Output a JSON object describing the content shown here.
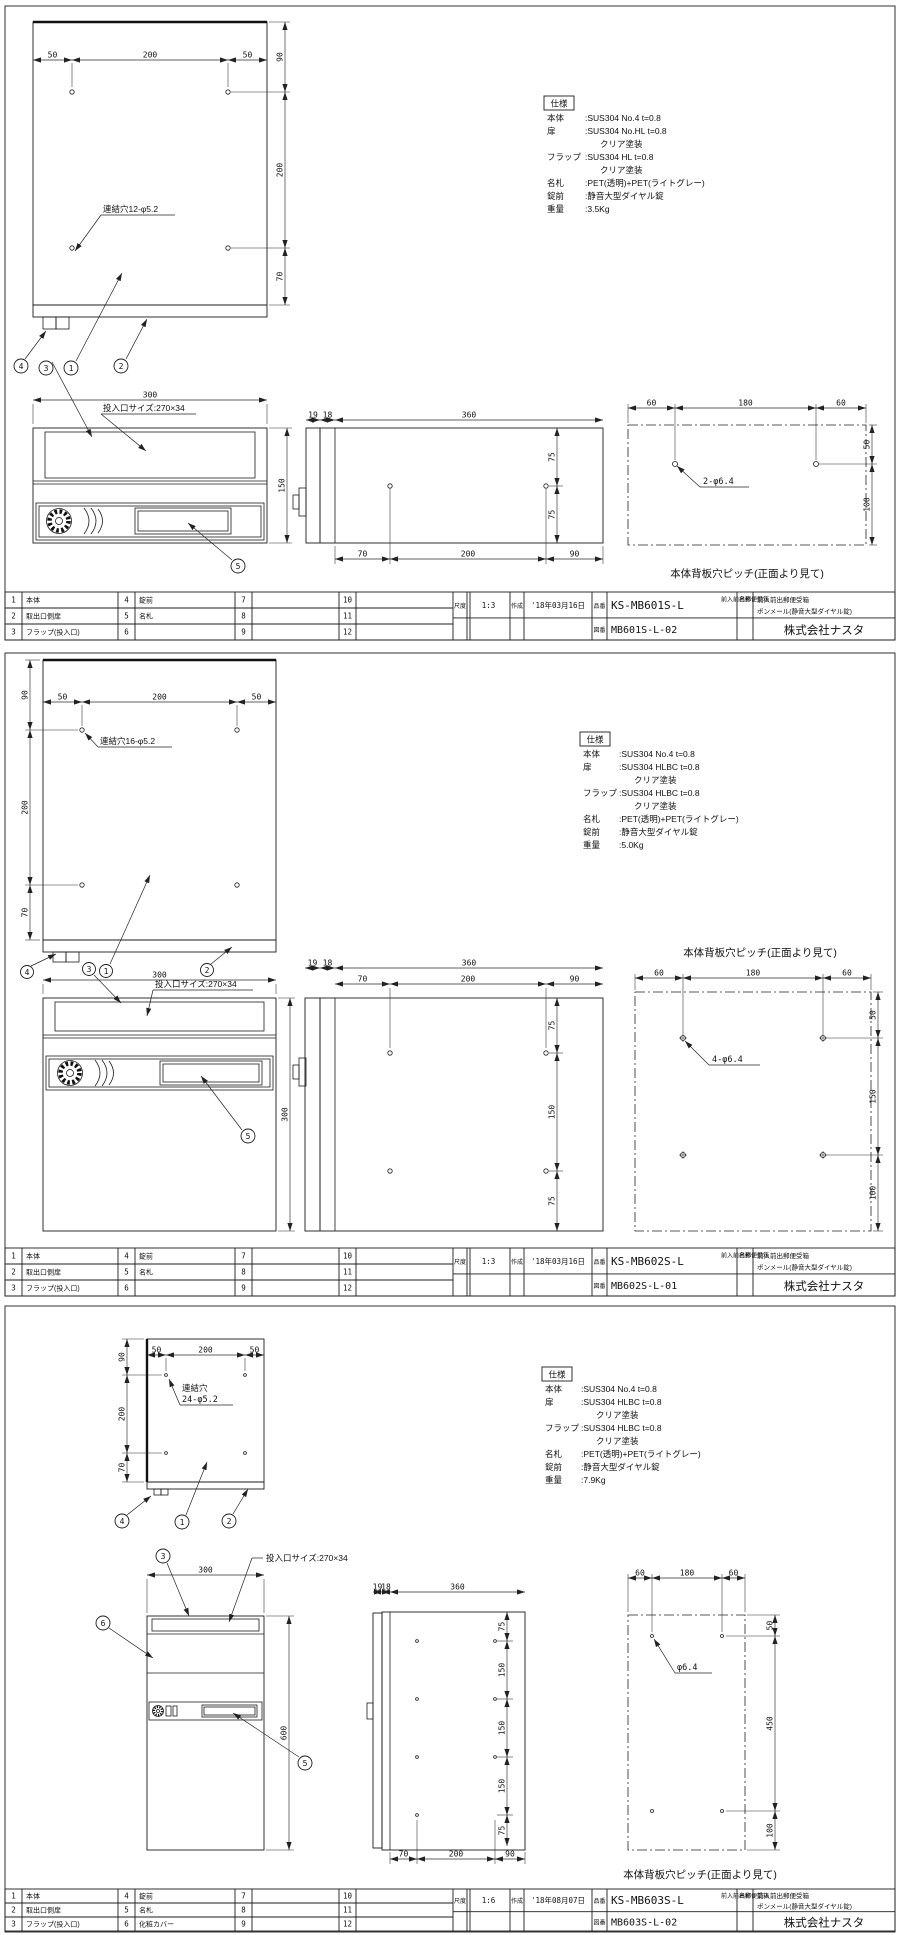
{
  "company": "株式会社ナスタ",
  "tb_labels": {
    "scale": "尺度",
    "made": "作成",
    "code": "品番",
    "dwg": "図番",
    "name": "名称"
  },
  "sheets": [
    {
      "title": {
        "scale": "1:3",
        "date": "'18年03月16日",
        "code": "KS-MB601S-L",
        "dwg": "MB601S-L-02",
        "name1": "前入前出郵便受箱",
        "name2": "ポンメール(静音大型ダイヤル錠)"
      },
      "spec": {
        "title": "仕様",
        "rows": [
          {
            "label": "本体",
            "value": ":SUS304 No.4 t=0.8"
          },
          {
            "label": "扉",
            "value": ":SUS304 No.HL t=0.8"
          },
          {
            "label": "",
            "value": "クリア塗装"
          },
          {
            "label": "フラップ",
            "value": ":SUS304 HL t=0.8"
          },
          {
            "label": "",
            "value": "クリア塗装"
          },
          {
            "label": "名札",
            "value": ":PET(透明)+PET(ライトグレー)"
          },
          {
            "label": "錠前",
            "value": ":静音大型ダイヤル錠"
          },
          {
            "label": "重量",
            "value": ":3.5Kg"
          }
        ]
      },
      "hole_label": "連結穴12-φ5.2",
      "slot_label": "投入口サイズ:270×34",
      "back_hole_label": "2-φ6.4",
      "back_caption": "本体背板穴ピッチ(正面より見て)",
      "callouts": {
        "c1": "1",
        "c2": "2",
        "c3": "3",
        "c4": "4",
        "c5": "5"
      },
      "dims": {
        "tv_top": [
          "50",
          "200",
          "50"
        ],
        "tv_side": [
          "90",
          "200",
          "70"
        ],
        "fv_w": "300",
        "fv_h": "150",
        "sv_front": [
          "19",
          "18"
        ],
        "sv_depth": "360",
        "sv_bottom": [
          "70",
          "200",
          "90"
        ],
        "sv_right": [
          "75",
          "75"
        ],
        "bv_top": [
          "60",
          "180",
          "60"
        ],
        "bv_right": [
          "50",
          "100"
        ]
      },
      "parts": [
        {
          "no": "1",
          "name": "本体"
        },
        {
          "no": "2",
          "name": "取出口側扉"
        },
        {
          "no": "3",
          "name": "フラップ(投入口)"
        },
        {
          "no": "4",
          "name": "錠前"
        },
        {
          "no": "5",
          "name": "名札"
        },
        {
          "no": "6",
          "name": ""
        },
        {
          "no": "7",
          "name": ""
        },
        {
          "no": "8",
          "name": ""
        },
        {
          "no": "9",
          "name": ""
        },
        {
          "no": "10",
          "name": ""
        },
        {
          "no": "11",
          "name": ""
        },
        {
          "no": "12",
          "name": ""
        }
      ]
    },
    {
      "title": {
        "scale": "1:3",
        "date": "'18年03月16日",
        "code": "KS-MB602S-L",
        "dwg": "MB602S-L-01",
        "name1": "前入前出郵便受箱",
        "name2": "ポンメール(静音大型ダイヤル錠)"
      },
      "spec": {
        "title": "仕様",
        "rows": [
          {
            "label": "本体",
            "value": ":SUS304 No.4 t=0.8"
          },
          {
            "label": "扉",
            "value": ":SUS304 HLBC t=0.8"
          },
          {
            "label": "",
            "value": "クリア塗装"
          },
          {
            "label": "フラップ",
            "value": ":SUS304 HLBC t=0.8"
          },
          {
            "label": "",
            "value": "クリア塗装"
          },
          {
            "label": "名札",
            "value": ":PET(透明)+PET(ライトグレー)"
          },
          {
            "label": "錠前",
            "value": ":静音大型ダイヤル錠"
          },
          {
            "label": "重量",
            "value": ":5.0Kg"
          }
        ]
      },
      "hole_label": "連結穴16-φ5.2",
      "slot_label": "投入口サイズ:270×34",
      "back_hole_label": "4-φ6.4",
      "back_caption": "本体背板穴ピッチ(正面より見て)",
      "callouts": {
        "c1": "1",
        "c2": "2",
        "c3": "3",
        "c4": "4",
        "c5": "5"
      },
      "dims": {
        "tv_top": [
          "50",
          "200",
          "50"
        ],
        "tv_side": [
          "90",
          "200",
          "70"
        ],
        "fv_w": "300",
        "fv_h": "300",
        "sv_front": [
          "19",
          "18"
        ],
        "sv_depth": "360",
        "sv_bottom": [
          "70",
          "200",
          "90"
        ],
        "sv_right": [
          "75",
          "150",
          "75"
        ],
        "bv_top": [
          "60",
          "180",
          "60"
        ],
        "bv_right": [
          "50",
          "150",
          "100"
        ]
      },
      "parts": [
        {
          "no": "1",
          "name": "本体"
        },
        {
          "no": "2",
          "name": "取出口側扉"
        },
        {
          "no": "3",
          "name": "フラップ(投入口)"
        },
        {
          "no": "4",
          "name": "錠前"
        },
        {
          "no": "5",
          "name": "名札"
        },
        {
          "no": "6",
          "name": ""
        },
        {
          "no": "7",
          "name": ""
        },
        {
          "no": "8",
          "name": ""
        },
        {
          "no": "9",
          "name": ""
        },
        {
          "no": "10",
          "name": ""
        },
        {
          "no": "11",
          "name": ""
        },
        {
          "no": "12",
          "name": ""
        }
      ]
    },
    {
      "title": {
        "scale": "1:6",
        "date": "'18年08月07日",
        "code": "KS-MB603S-L",
        "dwg": "MB603S-L-02",
        "name1": "前入前出郵便受箱",
        "name2": "ポンメール(静音大型ダイヤル錠)"
      },
      "spec": {
        "title": "仕様",
        "rows": [
          {
            "label": "本体",
            "value": ":SUS304 No.4 t=0.8"
          },
          {
            "label": "扉",
            "value": ":SUS304 HLBC t=0.8"
          },
          {
            "label": "",
            "value": "クリア塗装"
          },
          {
            "label": "フラップ",
            "value": ":SUS304 HLBC t=0.8"
          },
          {
            "label": "",
            "value": "クリア塗装"
          },
          {
            "label": "名札",
            "value": ":PET(透明)+PET(ライトグレー)"
          },
          {
            "label": "錠前",
            "value": ":静音大型ダイヤル錠"
          },
          {
            "label": "重量",
            "value": ":7.9Kg"
          }
        ]
      },
      "hole_label_1": "連結穴",
      "hole_label_2": "24-φ5.2",
      "slot_label": "投入口サイズ:270×34",
      "back_hole_label": "φ6.4",
      "back_caption": "本体背板穴ピッチ(正面より見て)",
      "callouts": {
        "c1": "1",
        "c2": "2",
        "c3": "3",
        "c4": "4",
        "c5": "5",
        "c6": "6"
      },
      "dims": {
        "tv_top": [
          "50",
          "200",
          "50"
        ],
        "tv_side": [
          "90",
          "200",
          "70"
        ],
        "fv_w": "300",
        "fv_h": "600",
        "sv_front": [
          "19",
          "18"
        ],
        "sv_depth": "360",
        "sv_bottom": [
          "70",
          "200",
          "90"
        ],
        "sv_right": [
          "75",
          "150",
          "150",
          "150",
          "75"
        ],
        "bv_top": [
          "60",
          "180",
          "60"
        ],
        "bv_right": [
          "50",
          "450",
          "100"
        ]
      },
      "parts": [
        {
          "no": "1",
          "name": "本体"
        },
        {
          "no": "2",
          "name": "取出口側扉"
        },
        {
          "no": "3",
          "name": "フラップ(投入口)"
        },
        {
          "no": "4",
          "name": "錠前"
        },
        {
          "no": "5",
          "name": "名札"
        },
        {
          "no": "6",
          "name": "化粧カバー"
        },
        {
          "no": "7",
          "name": ""
        },
        {
          "no": "8",
          "name": ""
        },
        {
          "no": "9",
          "name": ""
        },
        {
          "no": "10",
          "name": ""
        },
        {
          "no": "11",
          "name": ""
        },
        {
          "no": "12",
          "name": ""
        }
      ]
    }
  ]
}
